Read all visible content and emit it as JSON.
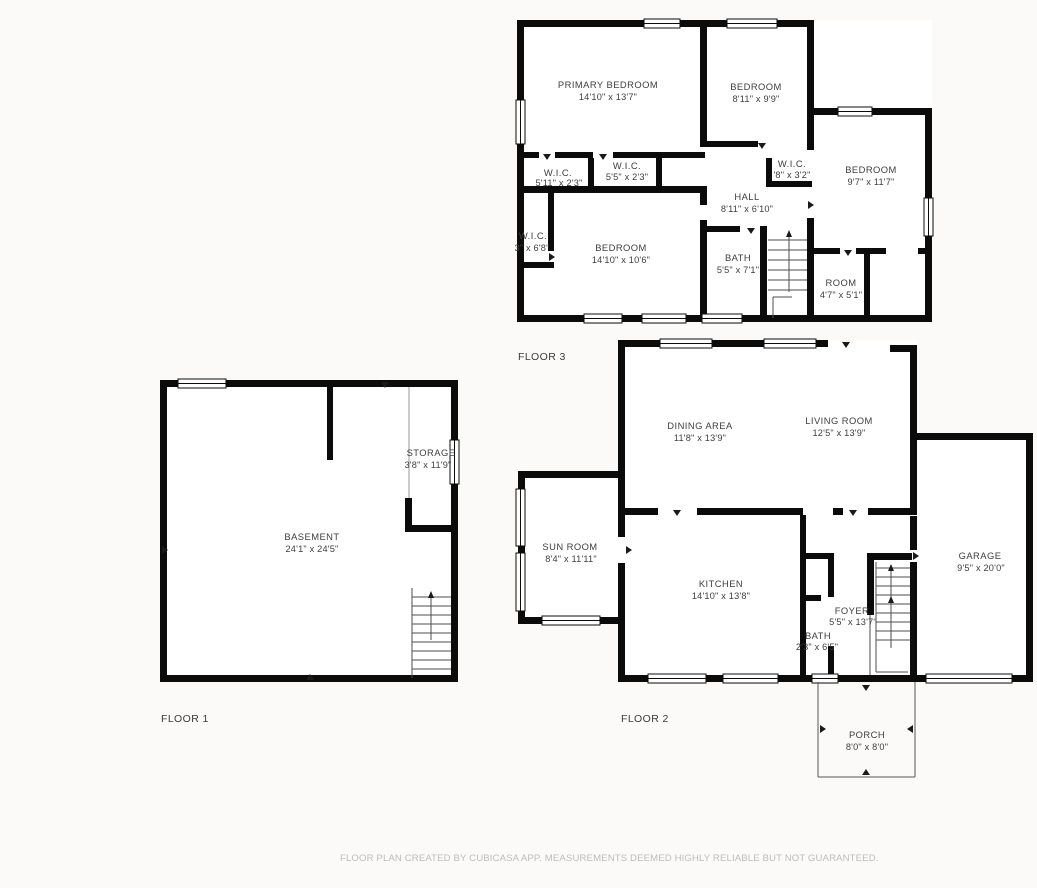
{
  "page": {
    "disclaimer": "FLOOR PLAN CREATED BY CUBICASA APP. MEASUREMENTS DEEMED HIGHLY RELIABLE BUT NOT GUARANTEED."
  },
  "colors": {
    "walls": "#0b0b0b",
    "room_text": "#3e3e3e",
    "disclaimer_text": "#bcbcbc",
    "background": "#fbfaf9"
  },
  "floors": [
    {
      "label": "FLOOR 3",
      "rooms": [
        {
          "name": "PRIMARY BEDROOM",
          "dims": "14'10\" x 13'7\""
        },
        {
          "name": "BEDROOM",
          "dims": "8'11\" x 9'9\""
        },
        {
          "name": "BEDROOM",
          "dims": "9'7\" x 11'7\""
        },
        {
          "name": "W.I.C.",
          "dims": "5'11\" x 2'3\""
        },
        {
          "name": "W.I.C.",
          "dims": "5'5\" x 2'3\""
        },
        {
          "name": "W.I.C.",
          "dims": "'8\" x 3'2\""
        },
        {
          "name": "W.I.C.",
          "dims": "3\" x 6'8\""
        },
        {
          "name": "HALL",
          "dims": "8'11\" x 6'10\""
        },
        {
          "name": "BEDROOM",
          "dims": "14'10\" x 10'6\""
        },
        {
          "name": "BATH",
          "dims": "5'5\" x 7'1\""
        },
        {
          "name": "ROOM",
          "dims": "4'7\" x 5'1\""
        }
      ]
    },
    {
      "label": "FLOOR 1",
      "rooms": [
        {
          "name": "BASEMENT",
          "dims": "24'1\" x 24'5\""
        },
        {
          "name": "STORAGE",
          "dims": "3'8\" x 11'9\""
        }
      ]
    },
    {
      "label": "FLOOR 2",
      "rooms": [
        {
          "name": "DINING AREA",
          "dims": "11'8\" x 13'9\""
        },
        {
          "name": "LIVING ROOM",
          "dims": "12'5\" x 13'9\""
        },
        {
          "name": "SUN ROOM",
          "dims": "8'4\" x 11'11\""
        },
        {
          "name": "KITCHEN",
          "dims": "14'10\" x 13'8\""
        },
        {
          "name": "BATH",
          "dims": "2'3\" x 6'5\""
        },
        {
          "name": "FOYER",
          "dims": "5'5\" x 13'7\""
        },
        {
          "name": "GARAGE",
          "dims": "9'5\" x 20'0\""
        },
        {
          "name": "PORCH",
          "dims": "8'0\" x 8'0\""
        }
      ]
    }
  ]
}
